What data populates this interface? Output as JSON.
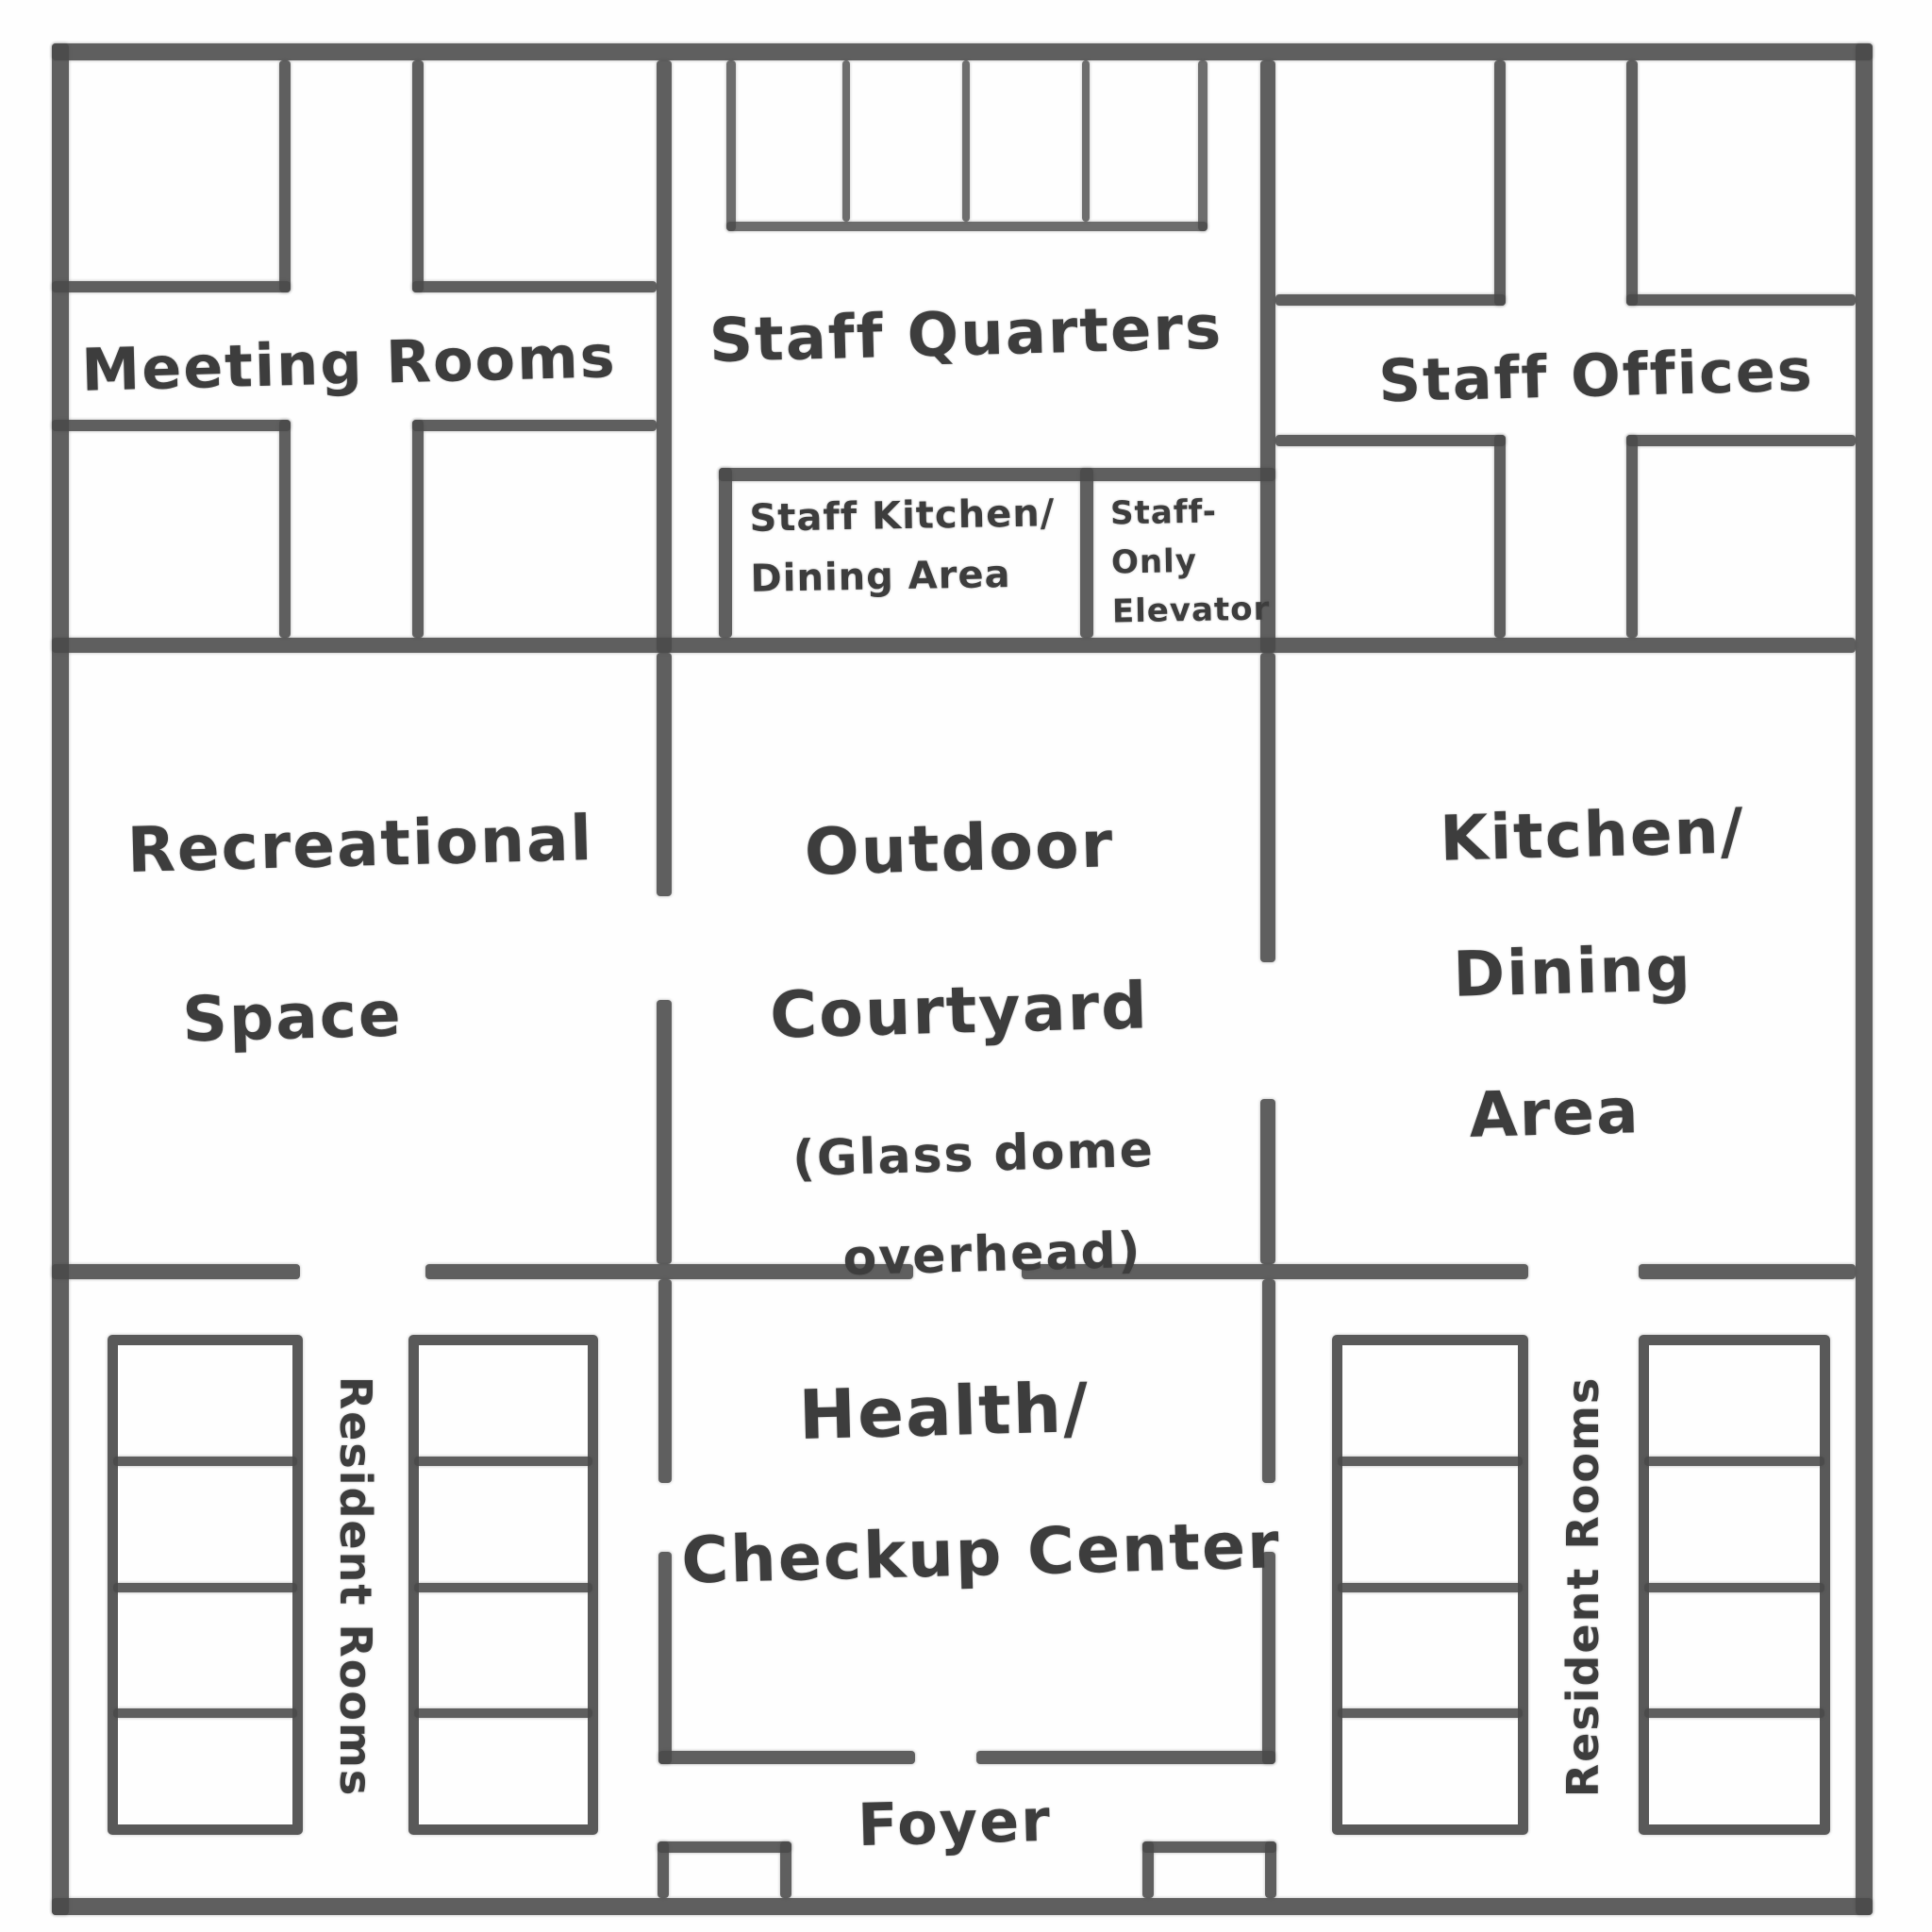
{
  "floorplan": {
    "style": {
      "ink_color": "#4a4a4a",
      "background": "#ffffff"
    },
    "areas": {
      "meeting_rooms": {
        "label": "Meeting Rooms"
      },
      "staff_quarters": {
        "label": "Staff Quarters"
      },
      "staff_offices": {
        "label": "Staff Offices"
      },
      "staff_kitchen": {
        "line1": "Staff Kitchen/",
        "line2": "Dining Area"
      },
      "staff_elevator": {
        "line1": "Staff-",
        "line2": "Only",
        "line3": "Elevator"
      },
      "recreational": {
        "line1": "Recreational",
        "line2": "Space"
      },
      "courtyard": {
        "line1": "Outdoor",
        "line2": "Courtyard",
        "line3": "(Glass dome",
        "line4": "overhead)"
      },
      "kitchen_dining": {
        "line1": "Kitchen/",
        "line2": "Dining",
        "line3": "Area"
      },
      "health_center": {
        "line1": "Health/",
        "line2": "Checkup Center"
      },
      "foyer": {
        "label": "Foyer"
      },
      "resident_rooms_left": {
        "label": "Resident Rooms"
      },
      "resident_rooms_right": {
        "label": "Resident Rooms"
      }
    }
  }
}
